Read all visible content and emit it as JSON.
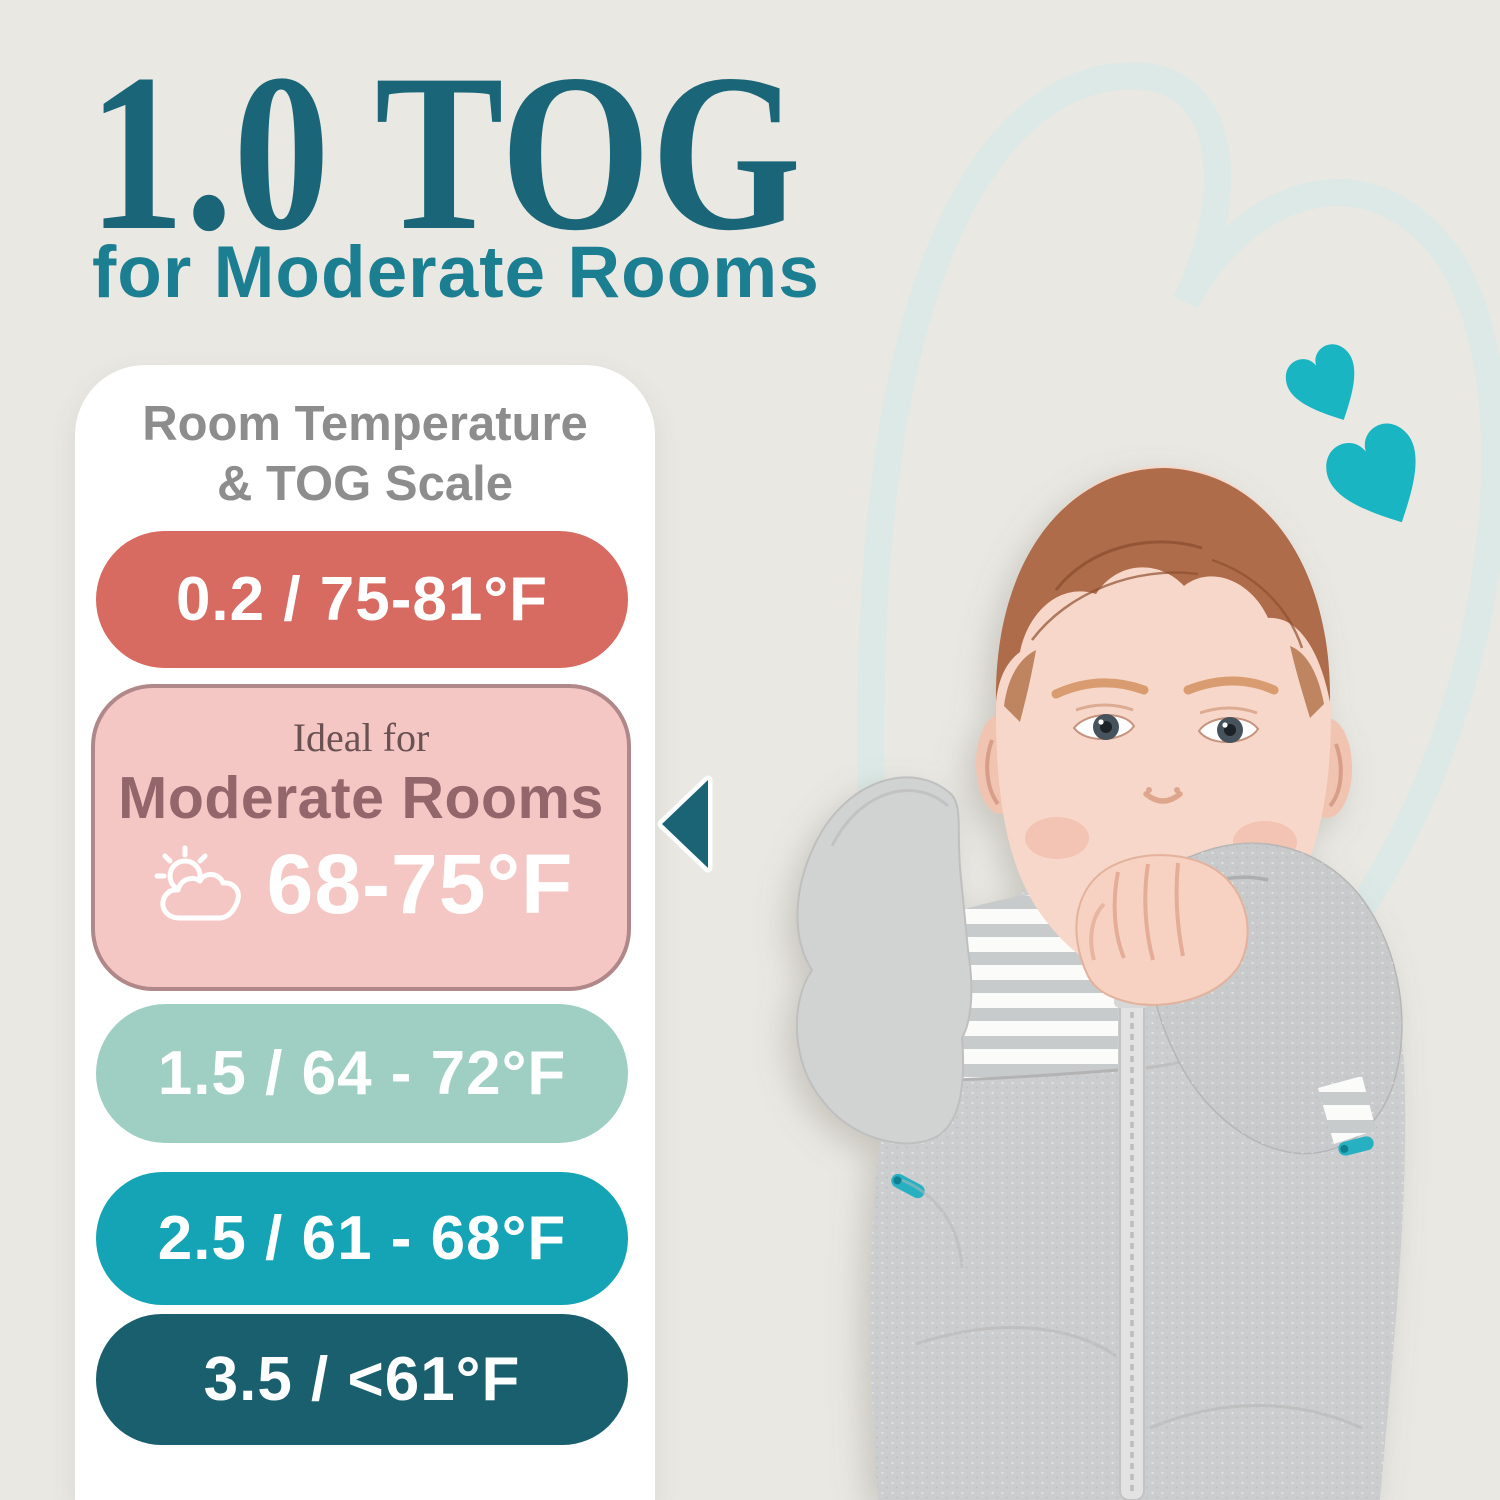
{
  "page": {
    "background": "#e9e8e3"
  },
  "title": {
    "text": "1.0 TOG",
    "color": "#1a6678"
  },
  "subtitle": {
    "text": "for Moderate Rooms",
    "color": "#1b7e91"
  },
  "scale_card": {
    "background": "#ffffff",
    "heading": {
      "line1": "Room Temperature",
      "line2": "& TOG Scale",
      "color": "#8d8d8d"
    },
    "pointer_color": "#1a6476",
    "rows": [
      {
        "label": "0.2 / 75-81°F",
        "bg": "#d76a61",
        "text_color": "#ffffff"
      },
      {
        "ideal_label": "Ideal for",
        "room_label": "Moderate Rooms",
        "temp_label": "68-75°F",
        "icon": "sun-behind-cloud",
        "bg": "#f4c7c5",
        "border_color": "#b08889",
        "ideal_color": "#6a5253",
        "room_color": "#92666b",
        "temp_color": "#ffffff"
      },
      {
        "label": "1.5 / 64 - 72°F",
        "bg": "#9fcfc2",
        "text_color": "#ffffff"
      },
      {
        "label": "2.5 / 61 - 68°F",
        "bg": "#14a4b6",
        "text_color": "#ffffff"
      },
      {
        "label": "3.5 / <61°F",
        "bg": "#1a5f6e",
        "text_color": "#ffffff"
      }
    ]
  },
  "decor": {
    "hearts_color": "#1ab5c3",
    "heart_outline_color": "#dce9e6"
  },
  "photo": {
    "alt": "Baby in gray arms-up swaddle sleep sack chewing fist",
    "swaddle_color": "#cccdce",
    "stripe_color": "#c7cbcc",
    "zipper_pull_color": "#27b0c2",
    "skin_color": "#f7d7c9",
    "hair_color": "#ae6c4b"
  }
}
